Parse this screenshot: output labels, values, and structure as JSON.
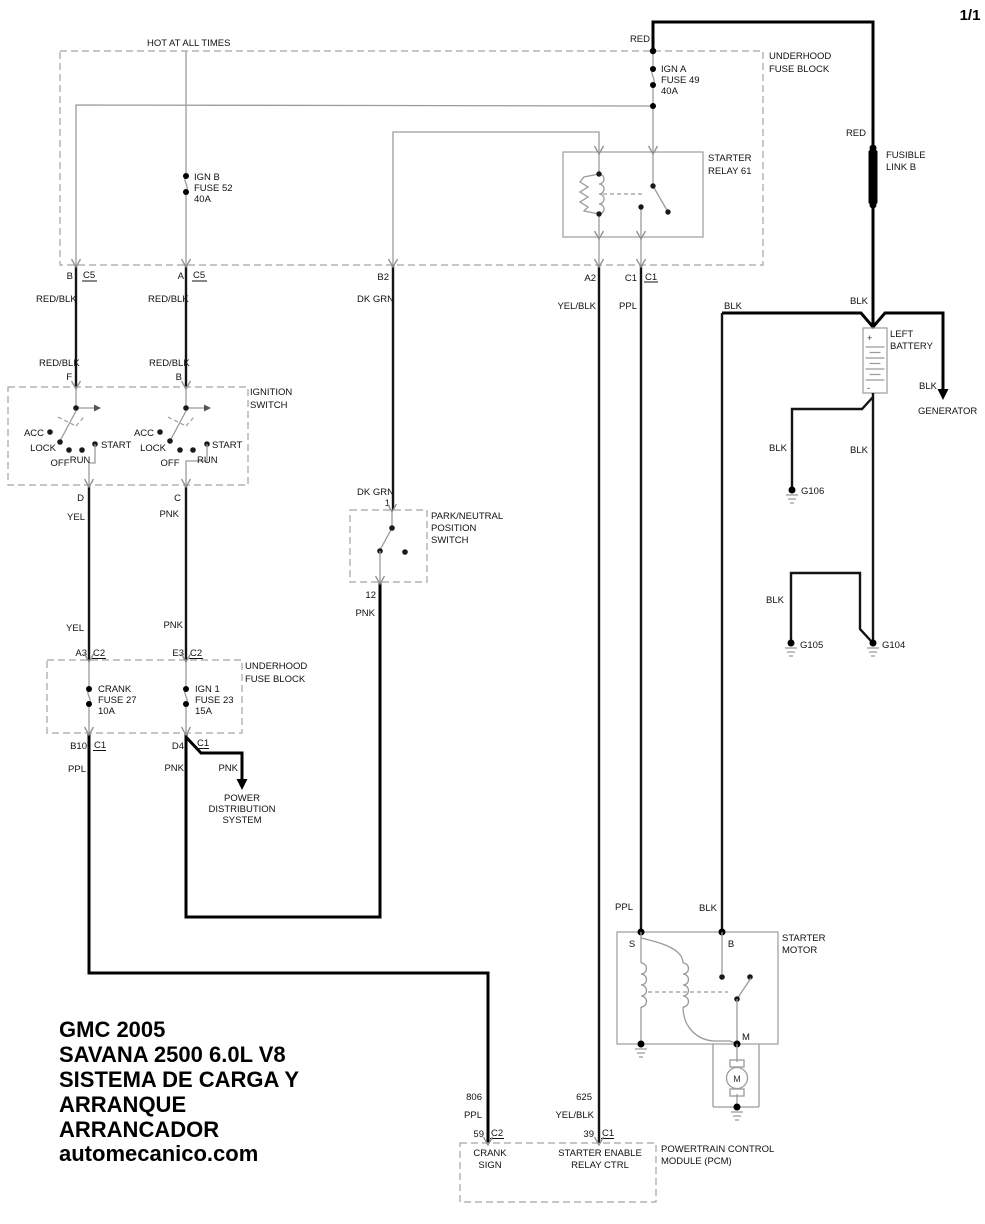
{
  "page": {
    "number": "1/1"
  },
  "colors": {
    "background": "#ffffff",
    "wire": "#000000",
    "component_gray": "#9b9b9b"
  },
  "wire_labels": {
    "red": "RED",
    "red_blk": "RED/BLK",
    "dk_grn": "DK GRN",
    "yel": "YEL",
    "pnk": "PNK",
    "ppl": "PPL",
    "yel_blk": "YEL/BLK",
    "blk": "BLK",
    "circuit_806": "806",
    "circuit_625": "625"
  },
  "top_fuse_block": {
    "hot_label": "HOT AT ALL TIMES",
    "name_line1": "UNDERHOOD",
    "name_line2": "FUSE BLOCK",
    "fuse_ign_a": {
      "row1": "IGN A",
      "row2": "FUSE 49",
      "row3": "40A"
    },
    "fuse_ign_b": {
      "row1": "IGN B",
      "row2": "FUSE 52",
      "row3": "40A"
    },
    "relay": {
      "line1": "STARTER",
      "line2": "RELAY 61"
    },
    "pins": {
      "b": "B",
      "a": "A",
      "c5": "C5",
      "b2": "B2",
      "a2": "A2",
      "c1": "C1"
    }
  },
  "fusible_link": {
    "line1": "FUSIBLE",
    "line2": "LINK B"
  },
  "battery": {
    "line1": "LEFT",
    "line2": "BATTERY",
    "plus": "+",
    "minus": "-"
  },
  "generator_label": "GENERATOR",
  "grounds": {
    "g106": "G106",
    "g105": "G105",
    "g104": "G104"
  },
  "ignition_switch": {
    "name_line1": "IGNITION",
    "name_line2": "SWITCH",
    "positions": {
      "acc": "ACC",
      "lock": "LOCK",
      "off": "OFF",
      "run": "RUN",
      "start": "START"
    },
    "pins": {
      "f": "F",
      "b": "B",
      "d": "D",
      "c": "C"
    }
  },
  "park_neutral_switch": {
    "name_line1": "PARK/NEUTRAL",
    "name_line2": "POSITION",
    "name_line3": "SWITCH",
    "pin_in": "1",
    "pin_out": "12"
  },
  "lower_fuse_block": {
    "name_line1": "UNDERHOOD",
    "name_line2": "FUSE BLOCK",
    "fuse_crank": {
      "row1": "CRANK",
      "row2": "FUSE 27",
      "row3": "10A"
    },
    "fuse_ign1": {
      "row1": "IGN 1",
      "row2": "FUSE 23",
      "row3": "15A"
    },
    "pins": {
      "a3": "A3",
      "e3": "E3",
      "c2": "C2",
      "b10": "B10",
      "d4": "D4",
      "c1": "C1"
    }
  },
  "power_distribution": {
    "line1": "POWER",
    "line2": "DISTRIBUTION",
    "line3": "SYSTEM"
  },
  "starter_motor": {
    "name_line1": "STARTER",
    "name_line2": "MOTOR",
    "pin_s": "S",
    "pin_b": "B",
    "pin_m": "M",
    "motor_symbol": "M"
  },
  "pcm": {
    "name_line1": "POWERTRAIN CONTROL",
    "name_line2": "MODULE (PCM)",
    "crank_sign": {
      "line1": "CRANK",
      "line2": "SIGN"
    },
    "starter_enable": {
      "line1": "STARTER ENABLE",
      "line2": "RELAY CTRL"
    },
    "pins": {
      "p59": "59",
      "c2": "C2",
      "p39": "39",
      "c1": "C1"
    }
  },
  "title_block": {
    "lines": [
      "GMC 2005",
      "SAVANA 2500 6.0L V8",
      "SISTEMA DE CARGA Y",
      "ARRANQUE",
      "ARRANCADOR",
      "automecanico.com"
    ]
  }
}
